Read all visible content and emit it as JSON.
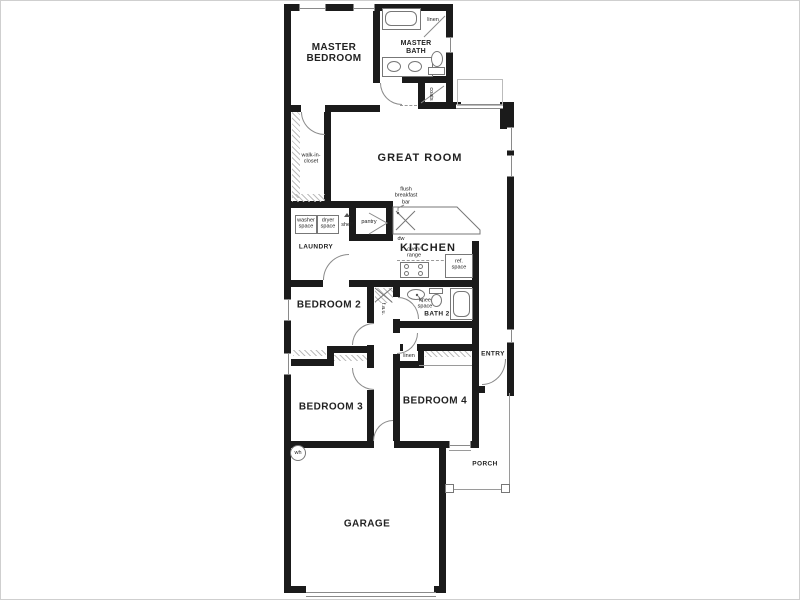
{
  "labels": {
    "master_bedroom": "MASTER\nBEDROOM",
    "master_bath": "MASTER\nBATH",
    "linen_top": "linen",
    "coats": "coats",
    "walk_in_closet": "walk-in-\ncloset",
    "great_room": "GREAT ROOM",
    "flush_breakfast_bar": "flush\nbreakfast\nbar",
    "washer_space": "washer\nspace",
    "dryer_space": "dryer\nspace",
    "shelf": "shelf",
    "pantry": "pantry",
    "laundry": "LAUNDRY",
    "dw": "dw",
    "kitchen": "KITCHEN",
    "oven_range": "oven/\nrange",
    "ref_space": "ref.\nspace",
    "bedroom2": "BEDROOM 2",
    "fau": "f.a.u.",
    "knee_space": "knee\nspace",
    "bath2": "BATH 2",
    "linen_hall": "linen",
    "entry": "ENTRY",
    "bedroom3": "BEDROOM 3",
    "bedroom4": "BEDROOM 4",
    "porch": "PORCH",
    "garage": "GARAGE",
    "wh": "wh"
  },
  "colors": {
    "wall": "#1b1b1b",
    "thin_line": "#8a8a8a",
    "hatch": "#bdbdbd",
    "text": "#222222",
    "background": "#ffffff",
    "frame_border": "#cfcfcf"
  }
}
